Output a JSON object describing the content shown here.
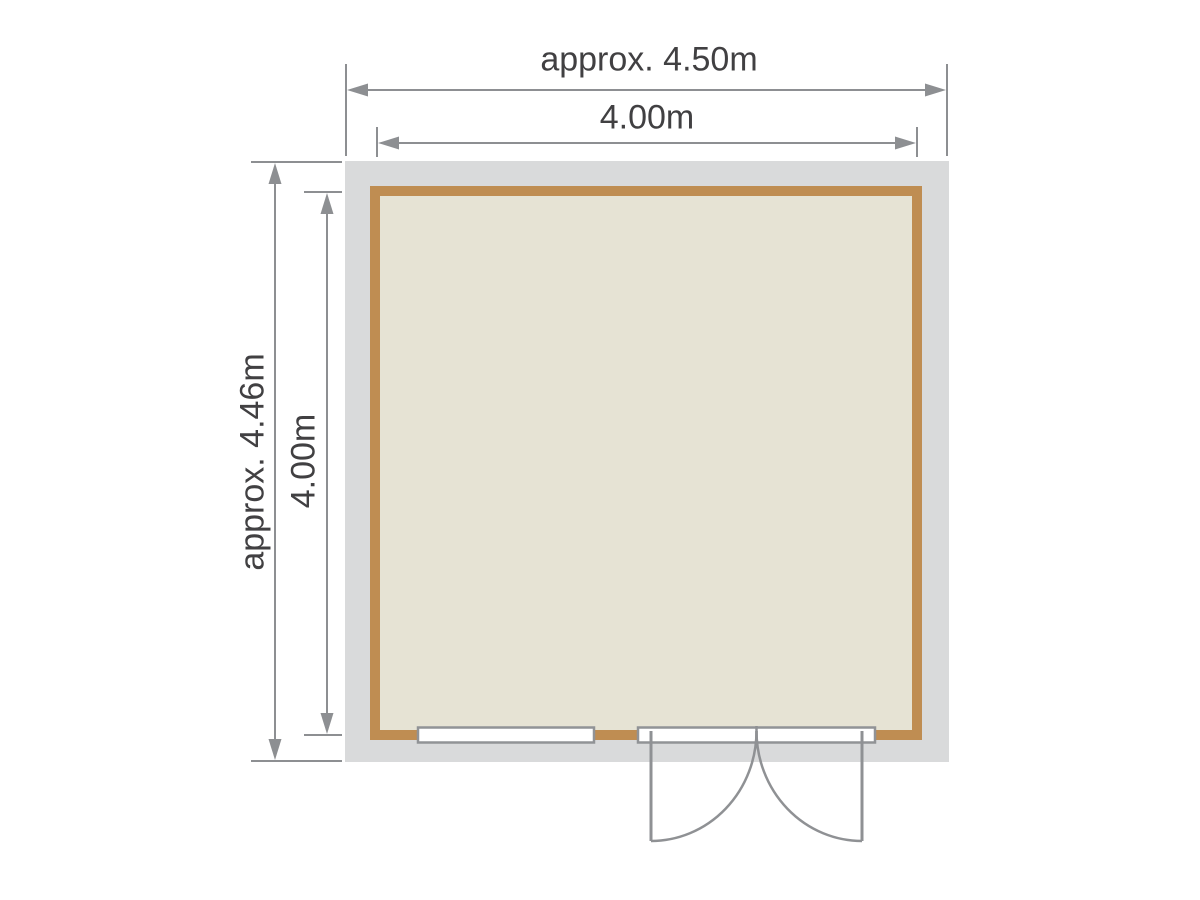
{
  "floor_plan": {
    "labels": {
      "width_overall": "approx. 4.50m",
      "width_internal": "4.00m",
      "depth_overall": "approx. 4.46m",
      "depth_internal": "4.00m"
    },
    "features": {
      "window": "window",
      "door": "double-door"
    },
    "colors": {
      "roof_overhang": "#d9dadb",
      "wall": "#bf8d52",
      "floor": "#e6e3d4",
      "dimension_lines": "#8d8f92",
      "label_text": "#414042",
      "opening_outline": "#919396",
      "background": "#ffffff"
    }
  }
}
